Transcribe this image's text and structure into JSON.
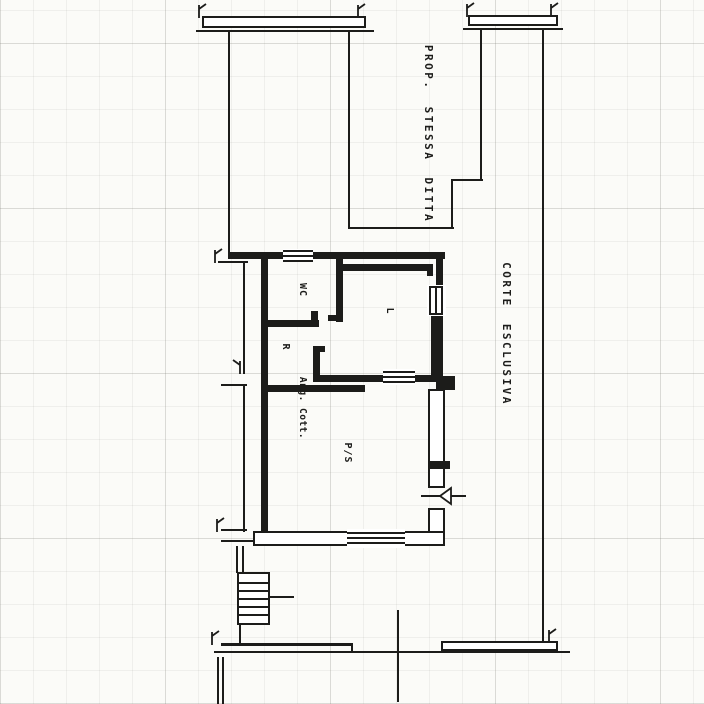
{
  "document": {
    "kind": "scanned cadastral floor plan",
    "orientation_note": "all lettering rotated 90 degrees clockwise"
  },
  "colors": {
    "ink": "#1c1c1a",
    "paper": "#fbfbf8"
  },
  "labels": {
    "neighbor_property": "PROP. STESSA DITTA",
    "courtyard": "CORTE ESCLUSIVA",
    "room_wc": "WC",
    "room_r": "R",
    "room_l": "L",
    "kitchenette": "Ang. Cott.",
    "main_room": "P/S"
  }
}
